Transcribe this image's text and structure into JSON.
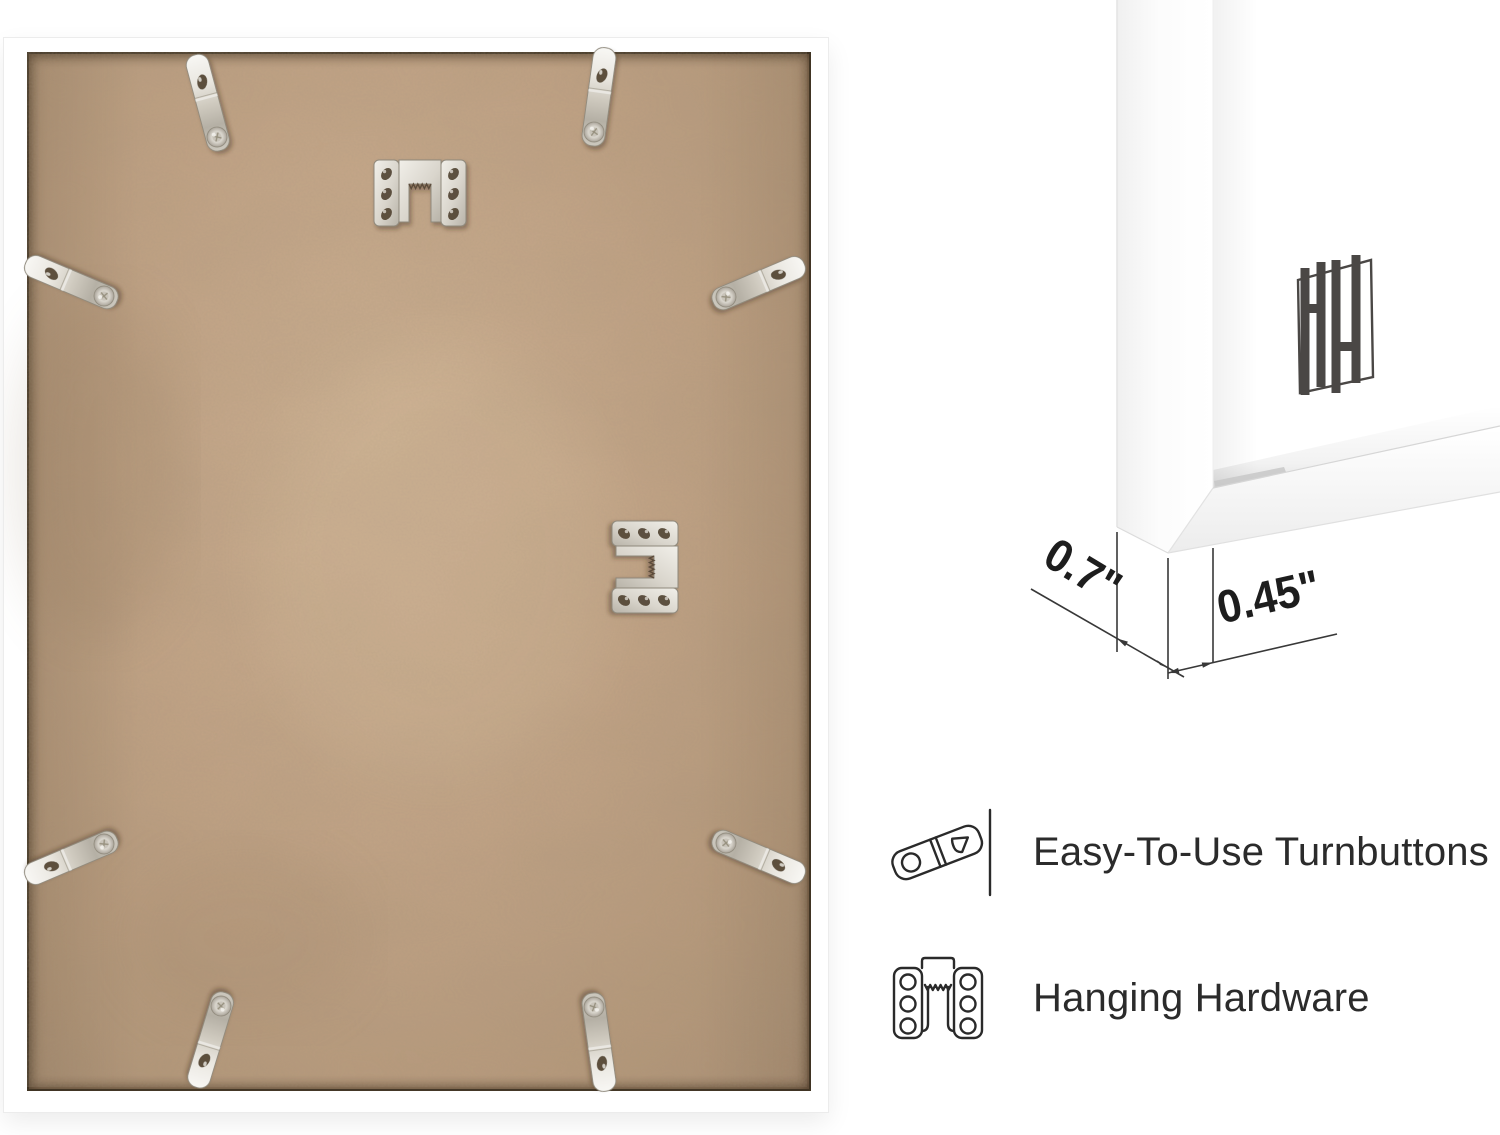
{
  "page": {
    "background_color": "#ffffff"
  },
  "photo": {
    "description": "Back of white picture frame with MDF backing board",
    "frame_color": "#ffffff",
    "board_color": "#c2a385",
    "metal_color": "#d6d2c9",
    "turnbutton_count": 8,
    "hanger_count": 2
  },
  "corner_render": {
    "frame_color": "#ffffff",
    "logo": "HH monogram",
    "logo_color": "#4a4745",
    "line_color": "#383838",
    "measurements": {
      "side_depth": "0.7\"",
      "face_width": "0.45\""
    }
  },
  "features": [
    {
      "icon": "turnbutton-icon",
      "label": "Easy-To-Use Turnbuttons"
    },
    {
      "icon": "hanging-hardware-icon",
      "label": "Hanging Hardware"
    }
  ]
}
